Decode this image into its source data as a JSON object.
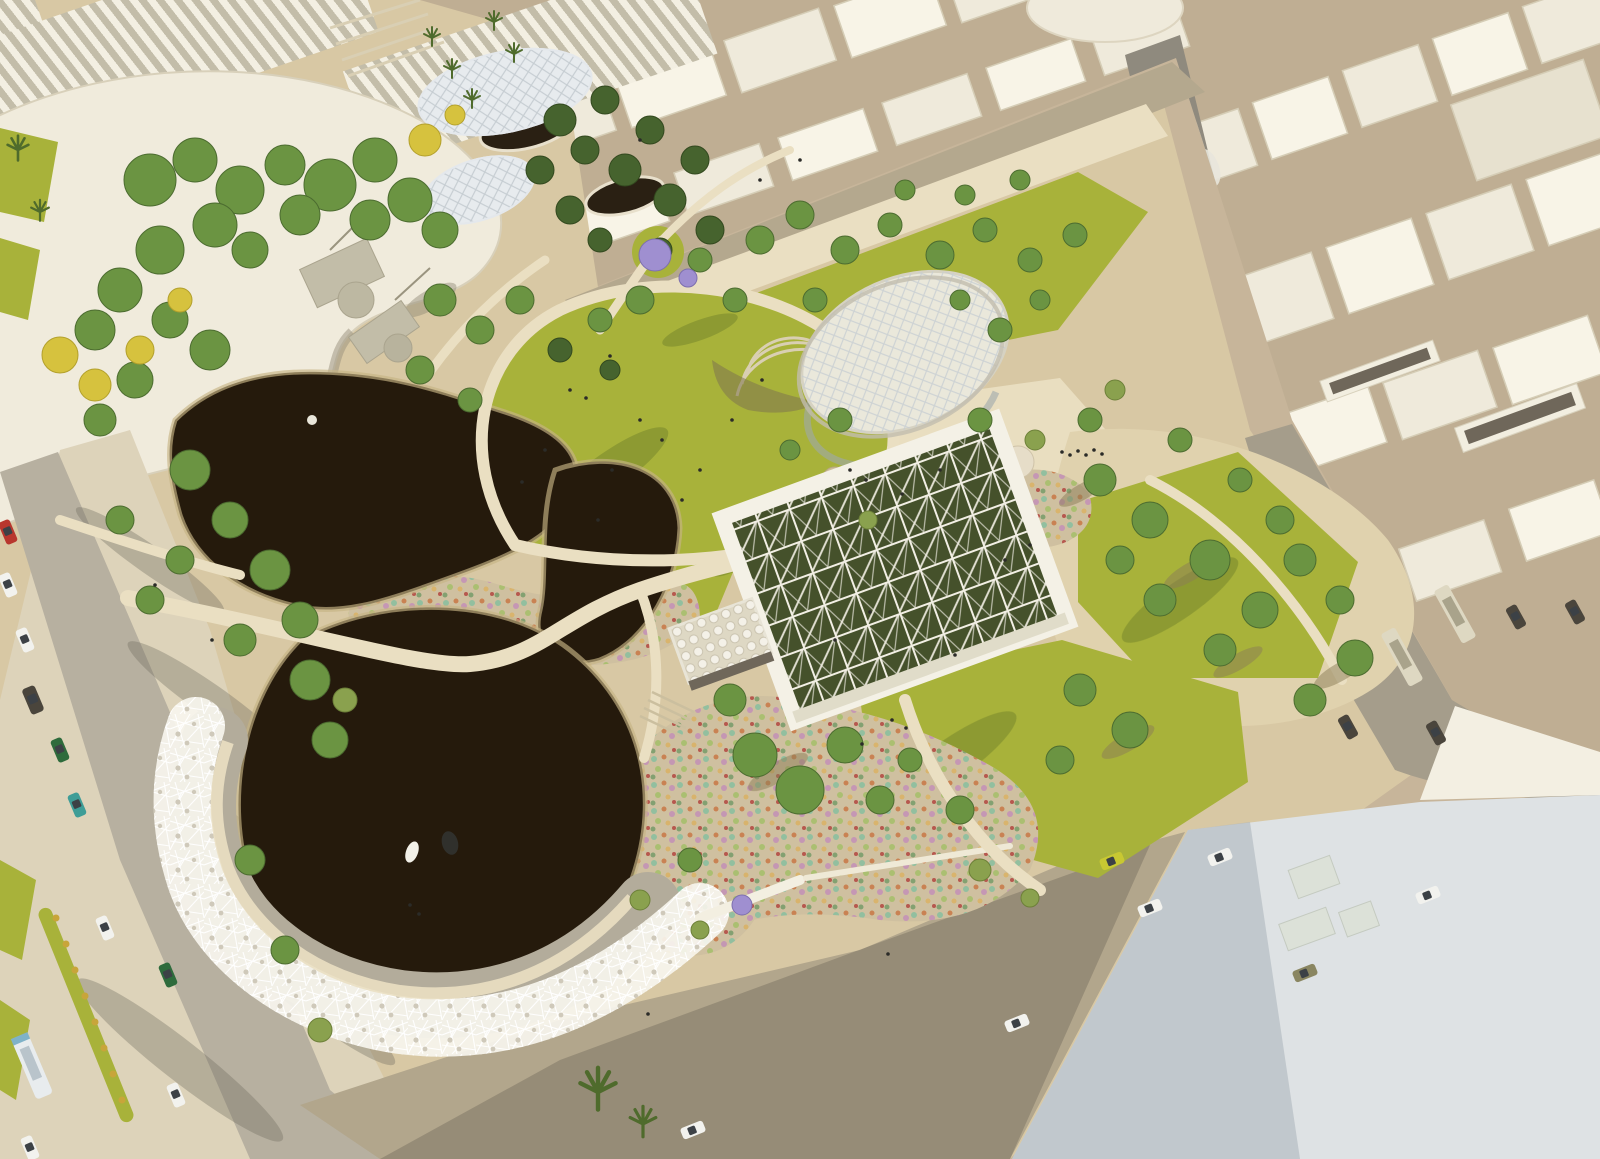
{
  "meta": {
    "title": "Aerial architectural rendering of an urban park masterplan",
    "view": "bird's-eye perspective, afternoon sun from the right, long shadows to lower-left",
    "no_visible_text": true
  },
  "palette": {
    "bg_sand": "#c7b59a",
    "city_ground": "#bfae93",
    "bldg_roof": "#efeadb",
    "bldg_lit": "#f8f4e7",
    "bldg_shade": "#d5cdb6",
    "boulevard": "#8f8a7e",
    "median_white": "#e8e6dc",
    "road_left": "#b7b0a0",
    "road_bottom": "#b2a68c",
    "road_shadow": "#5c564a",
    "sidewalk": "#ddd3ba",
    "path": "#eadfc2",
    "park_sand": "#d8c8a4",
    "garden_sand": "#cfc0a0",
    "sand_right": "#e0d2ae",
    "lawn": "#a8b23a",
    "lawn_shade": "#6d7e2a",
    "pond": "#251a0c",
    "pond_bank": "#c6b384",
    "tree_green": "#6b9442",
    "tree_dark": "#46632e",
    "tree_olive": "#8aa14e",
    "tree_yellow": "#d6c23e",
    "tree_purple": "#9f8fd0",
    "palm_green": "#4f6b2c",
    "curvy_roof": "#f0ebdc",
    "web_white": "#f7f5ee",
    "web_ground": "#b3ac9b",
    "pavilion_frame": "#f4f1e6",
    "pavilion_interior": "#45512b",
    "oval_roof": "#eae8db",
    "lattice_line": "#c6cdd2",
    "glass": "#9fa8ac",
    "big_roof": "#dee2e4",
    "big_roof_shade": "#a9b2ba",
    "metro_slot": "#6f675a",
    "car_white": "#f2f2ee",
    "car_red": "#b8372e",
    "car_teal": "#3e9d97",
    "car_green": "#2e6b3c",
    "car_dark": "#4a453c",
    "car_yellow": "#c8c832",
    "car_khaki": "#8a8661",
    "car_glass": "#3c4146",
    "bus_white": "#e8ecee",
    "bus_stripe": "#7fb2c8",
    "bus_cream": "#ded8c2",
    "people": "#2b2b28",
    "chair_white": "#ffffff",
    "flower_teal": "#8fbf9f",
    "flower_orange": "#c97f4f",
    "flower_pink": "#c495b5",
    "flower_lime": "#a9bf6f",
    "flower_gold": "#d9b36a",
    "flower_red": "#b5534a"
  },
  "scene": {
    "objects": [
      {
        "name": "curved-roof-museum",
        "note": "large organic white roof building, top-left"
      },
      {
        "name": "sawtooth-halls",
        "note": "zigzag shed-roof exhibition halls behind museum"
      },
      {
        "name": "city-blocks",
        "note": "untextured cream massing model of city, top and right"
      },
      {
        "name": "boulevard",
        "note": "grey avenue with white oval tram medians, top-right"
      },
      {
        "name": "park-canopy-discs",
        "note": "two iridescent leaf-shaped lattice canopies"
      },
      {
        "name": "sunken-craters",
        "note": "dark circular sunken gardens under canopies"
      },
      {
        "name": "upper-pond",
        "note": "dark organic pond, centre-left"
      },
      {
        "name": "round-pond",
        "note": "large dark circular pond, lower-left"
      },
      {
        "name": "nest-canopy-ring",
        "note": "white woven lattice band wrapping the round pond"
      },
      {
        "name": "bird-sculptures",
        "note": "heron sculptures standing in the round pond"
      },
      {
        "name": "flower-gardens",
        "note": "dry gardens with teal/orange/pink flowering shrubs"
      },
      {
        "name": "great-lawn",
        "note": "teardrop event lawn with scattered people"
      },
      {
        "name": "lattice-pavilion",
        "note": "square white space-frame pavilion over green court"
      },
      {
        "name": "pebble-canopy",
        "note": "small faceted white canopy with stair, west of pavilion"
      },
      {
        "name": "oval-pavilion",
        "note": "tilted oval roof pavilion with diagrid and glass wall"
      },
      {
        "name": "chair-circle",
        "note": "circle of white chairs on plaza"
      },
      {
        "name": "tree-groves",
        "note": "pines, broadleaf rows, yellow & jacaranda trees"
      },
      {
        "name": "metro-entrances",
        "note": "sunken ramped slots in white plinth, right"
      },
      {
        "name": "left-road",
        "note": "street with cars, bus and planted median, bottom-left"
      },
      {
        "name": "bottom-road",
        "note": "wide tan road with cars along south edge"
      },
      {
        "name": "transit-road",
        "note": "grey road with two buses, right side"
      },
      {
        "name": "big-roof-building",
        "note": "huge pale flat roof, bottom-right corner"
      }
    ],
    "vehicle_counts": {
      "cars": 20,
      "buses": 3
    },
    "bird_sculptures": 2
  }
}
